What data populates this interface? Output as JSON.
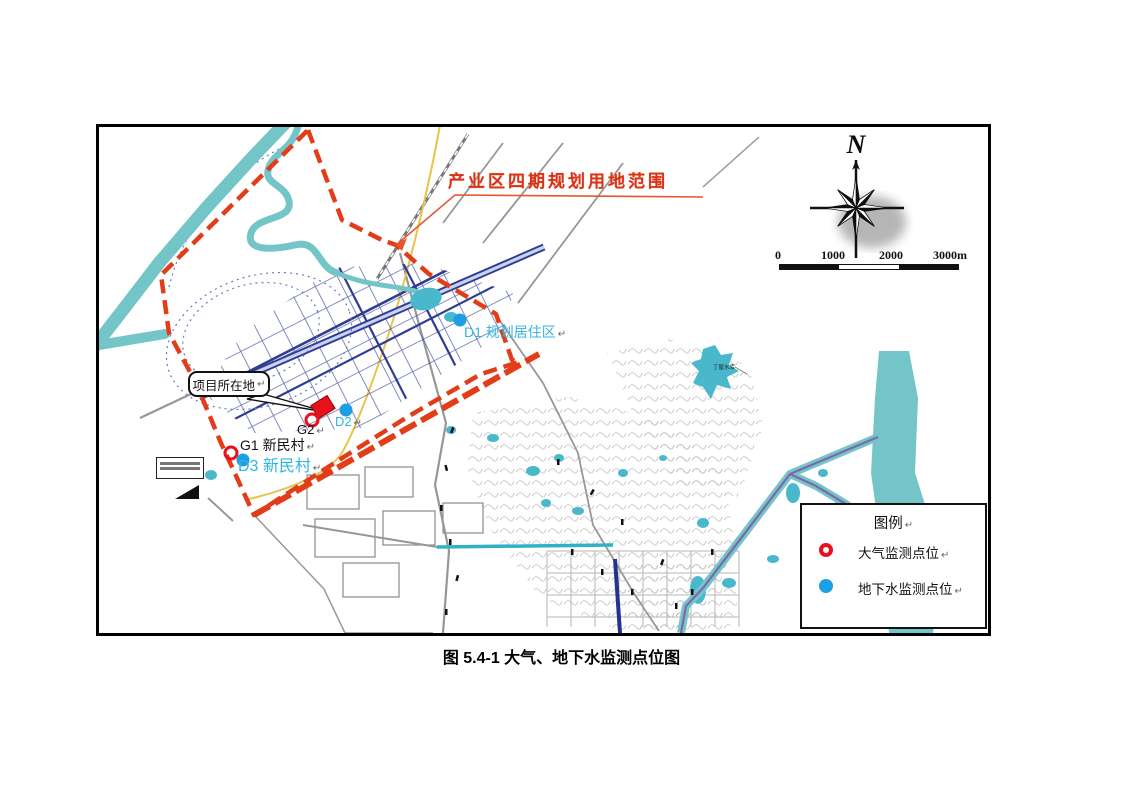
{
  "figure": {
    "caption": "图 5.4-1 大气、地下水监测点位图"
  },
  "map": {
    "boundary_label": "产业区四期规划用地范围",
    "callout_label": "项目所在地",
    "reservoir_label": "丁屋水库",
    "points": [
      {
        "id": "G1",
        "kind": "air",
        "label": "G1 新民村",
        "x": 231,
        "y": 453,
        "lx": 240,
        "ly": 438,
        "fs": 14,
        "color": "#111111"
      },
      {
        "id": "G2",
        "kind": "air",
        "label": "G2",
        "x": 312,
        "y": 420,
        "lx": 297,
        "ly": 423,
        "fs": 13,
        "color": "#111111"
      },
      {
        "id": "D1",
        "kind": "groundwater",
        "label": "D1 规划居住区",
        "x": 460,
        "y": 320,
        "lx": 464,
        "ly": 325,
        "fs": 14,
        "color": "#2fb4e4"
      },
      {
        "id": "D2",
        "kind": "groundwater",
        "label": "D2",
        "x": 346,
        "y": 410,
        "lx": 335,
        "ly": 415,
        "fs": 13,
        "color": "#2fb4e4"
      },
      {
        "id": "D3",
        "kind": "groundwater",
        "label": "D3 新民村",
        "x": 243,
        "y": 460,
        "lx": 238,
        "ly": 459,
        "fs": 16,
        "color": "#2fb4e4"
      }
    ]
  },
  "compass": {
    "label": "N"
  },
  "scalebar": {
    "ticks": [
      "0",
      "1000",
      "2000",
      "3000m"
    ]
  },
  "legend": {
    "title": "图例",
    "items": [
      {
        "symbol": "air-monitoring-point",
        "label": "大气监测点位"
      },
      {
        "symbol": "groundwater-monitoring-point",
        "label": "地下水监测点位"
      }
    ]
  },
  "misc": {
    "return_mark": "↵"
  },
  "colors": {
    "boundary_red": "#e23c18",
    "label_red": "#d8321a",
    "water_cyan": "#74c5c8",
    "pond_cyan": "#49b8cc",
    "grid_blue": "#2e3d92",
    "point_red": "#e8101c",
    "point_blue": "#1e9fe4",
    "cyan_label": "#2fb4e4",
    "purple": "#7e68ab",
    "yellow": "#e7c44b",
    "teal_road": "#2fb3c4"
  }
}
